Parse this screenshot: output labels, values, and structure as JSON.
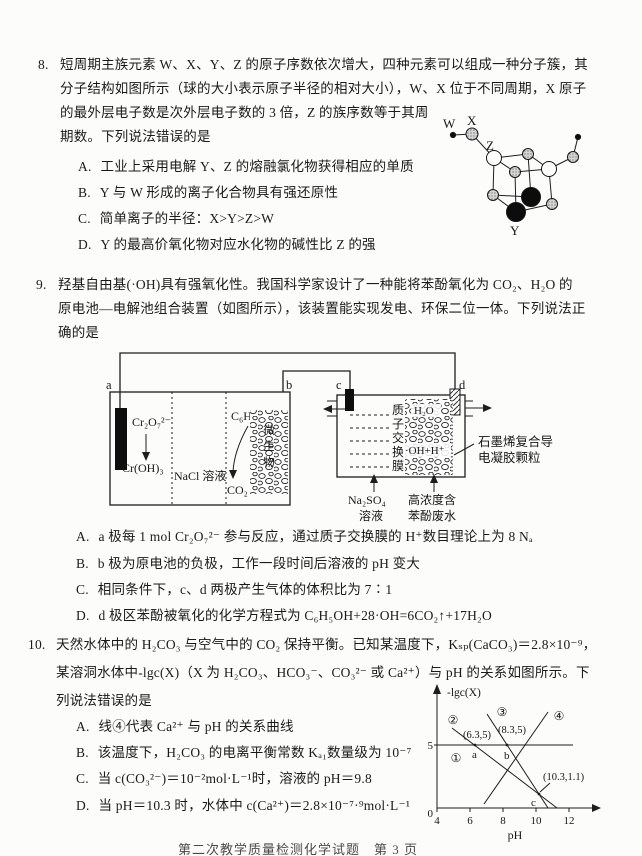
{
  "page": {
    "footer": "第二次教学质量检测化学试题　第 3 页"
  },
  "q8": {
    "number": "8.",
    "lines": [
      "短周期主族元素 W、X、Y、Z 的原子序数依次增大，四种元素可以组成一种分子簇，其",
      "分子结构如图所示（球的大小表示原子半径的相对大小），W、X 位于不同周期，X 原子",
      "的最外层电子数是次外层电子数的 3 倍，Z 的族序数等于其周",
      "期数。下列说法错误的是"
    ],
    "options": [
      {
        "label": "A.",
        "text": "工业上采用电解 Y、Z 的熔融氯化物获得相应的单质"
      },
      {
        "label": "B.",
        "text": "Y 与 W 形成的离子化合物具有强还原性"
      },
      {
        "label": "C.",
        "text": "简单离子的半径：X>Y>Z>W"
      },
      {
        "label": "D.",
        "text": "Y 的最高价氧化物对应水化物的碱性比 Z 的强"
      }
    ],
    "molecule": {
      "w": "W",
      "x": "X",
      "y": "Y",
      "z": "Z"
    }
  },
  "q9": {
    "number": "9.",
    "lines": [
      "羟基自由基(·OH)具有强氧化性。我国科学家设计了一种能将苯酚氧化为 CO₂、H₂O 的",
      "原电池—电解池组合装置（如图所示），该装置能实现发电、环保二位一体。下列说法正",
      "确的是"
    ],
    "diagram": {
      "a": "a",
      "b": "b",
      "c": "c",
      "d": "d",
      "dichromate": "Cr₂O₇²⁻",
      "chromium_hydroxide": "Cr(OH)₃",
      "nacl_solution": "NaCl 溶液",
      "phenol": "C₆H₅OH",
      "co2": "CO₂",
      "microbes": "微生物",
      "membrane": "质子交换膜",
      "water": "H₂O",
      "radical": "·OH+H⁺",
      "gel1": "石墨烯复合导",
      "gel2": "电凝胶颗粒",
      "na2so4_1": "Na₂SO₄",
      "na2so4_2": "溶液",
      "waste1": "高浓度含",
      "waste2": "苯酚废水"
    },
    "options": [
      {
        "label": "A.",
        "text": "a 极每 1 mol Cr₂O₇²⁻ 参与反应，通过质子交换膜的 H⁺数目理论上为 8 Nₐ"
      },
      {
        "label": "B.",
        "text": "b 极为原电池的负极，工作一段时间后溶液的 pH 变大"
      },
      {
        "label": "C.",
        "text": "相同条件下，c、d 两极产生气体的体积比为 7∶1"
      },
      {
        "label": "D.",
        "text": "d 极区苯酚被氧化的化学方程式为 C₆H₅OH+28·OH=6CO₂↑+17H₂O"
      }
    ]
  },
  "q10": {
    "number": "10.",
    "lines": [
      "天然水体中的 H₂CO₃ 与空气中的 CO₂ 保持平衡。已知某温度下，Kₛₚ(CaCO₃)＝2.8×10⁻⁹，",
      "某溶洞水体中-lgc(X)（X 为 H₂CO₃、HCO₃⁻、CO₃²⁻ 或 Ca²⁺）与 pH 的关系如图所示。下",
      "列说法错误的是"
    ],
    "options": [
      {
        "label": "A.",
        "text": "线④代表 Ca²⁺ 与 pH 的关系曲线"
      },
      {
        "label": "B.",
        "text": "该温度下，H₂CO₃ 的电离平衡常数 Kₐ₁数量级为 10⁻⁷"
      },
      {
        "label": "C.",
        "text": "当 c(CO₃²⁻)＝10⁻²mol·L⁻¹时，溶液的 pH＝9.8"
      },
      {
        "label": "D.",
        "text": "当 pH＝10.3 时，水体中 c(Ca²⁺)＝2.8×10⁻⁷·⁹mol·L⁻¹"
      }
    ],
    "graph": {
      "ylabel": "-lgc(X)",
      "xlabel": "pH",
      "ytick5": "5",
      "origin": "0",
      "xticks": [
        "4",
        "6",
        "8",
        "10",
        "12"
      ],
      "curve1": "①",
      "curve2": "②",
      "curve3": "③",
      "curve4": "④",
      "pt_a": "(6.3,5)",
      "pt_b": "(8.3,5)",
      "pt_c": "(10.3,1.1)",
      "lbl_a": "a",
      "lbl_b": "b",
      "lbl_c": "c"
    }
  },
  "chart_data": {
    "type": "line",
    "title": "",
    "xlabel": "pH",
    "ylabel": "-lgc(X)",
    "xlim": [
      4,
      12
    ],
    "ylim": [
      0,
      8
    ],
    "x_ticks": [
      4,
      6,
      8,
      10,
      12
    ],
    "y_ticks": [
      0,
      5
    ],
    "grid": false,
    "legend_position": "none",
    "series": [
      {
        "name": "①",
        "description": "水平线 -lgc=5",
        "points": [
          [
            4,
            5
          ],
          [
            12.3,
            5
          ]
        ]
      },
      {
        "name": "②",
        "description": "斜率约-1，过(6.3,5)",
        "points": [
          [
            4.9,
            6.4
          ],
          [
            11.3,
            0
          ]
        ]
      },
      {
        "name": "③",
        "description": "斜率约-2，过(8.3,5)",
        "points": [
          [
            7.1,
            7.5
          ],
          [
            10.8,
            0
          ]
        ]
      },
      {
        "name": "④",
        "description": "上升线，斜率约+2",
        "points": [
          [
            6.9,
            0.3
          ],
          [
            10.8,
            7.7
          ]
        ]
      }
    ],
    "labeled_points": [
      {
        "label": "a",
        "xy": [
          6.3,
          5
        ]
      },
      {
        "label": "b",
        "xy": [
          8.3,
          5
        ]
      },
      {
        "label": "c",
        "xy": [
          10.3,
          1.1
        ]
      }
    ]
  }
}
